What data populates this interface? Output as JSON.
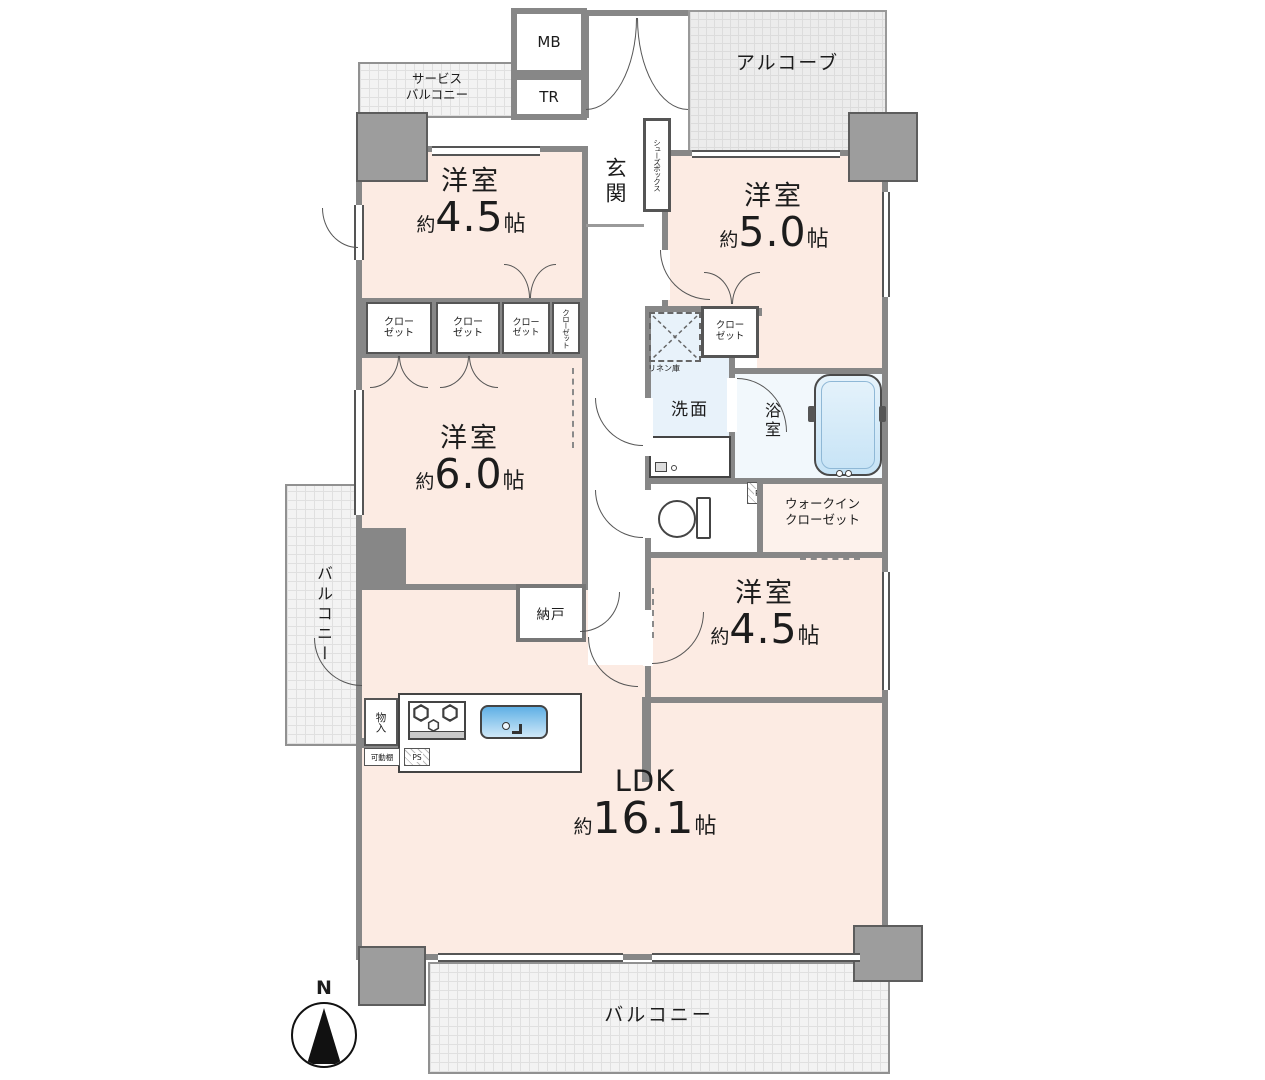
{
  "plan": {
    "compass": {
      "north": "N"
    },
    "alcove": {
      "label": "アルコーブ"
    },
    "service_balcony": {
      "line1": "サービス",
      "line2": "バルコニー"
    },
    "boxes": {
      "mb": "MB",
      "tr": "TR"
    },
    "entrance": {
      "genkan": "玄関",
      "shoes_box": "シューズボックス"
    },
    "rooms": {
      "nw": {
        "name": "洋室",
        "approx": "約",
        "size": "4.5",
        "unit": "帖"
      },
      "ne": {
        "name": "洋室",
        "approx": "約",
        "size": "5.0",
        "unit": "帖"
      },
      "west": {
        "name": "洋室",
        "approx": "約",
        "size": "6.0",
        "unit": "帖"
      },
      "se": {
        "name": "洋室",
        "approx": "約",
        "size": "4.5",
        "unit": "帖"
      },
      "ldk": {
        "name": "LDK",
        "approx": "約",
        "size": "16.1",
        "unit": "帖"
      }
    },
    "storage": {
      "closet_line1": "クロー",
      "closet_line2": "ゼット",
      "closet_vertical": "クローゼット",
      "wic_line1": "ウォークイン",
      "wic_line2": "クローゼット",
      "nando": "納戸",
      "monoire": "物入",
      "movable_shelf": "可動棚",
      "linen": "リネン庫"
    },
    "water": {
      "washroom": "洗面",
      "bath": "浴室"
    },
    "ps": "PS",
    "balcony": {
      "left": "バルコニー",
      "bottom": "バルコニー"
    }
  }
}
